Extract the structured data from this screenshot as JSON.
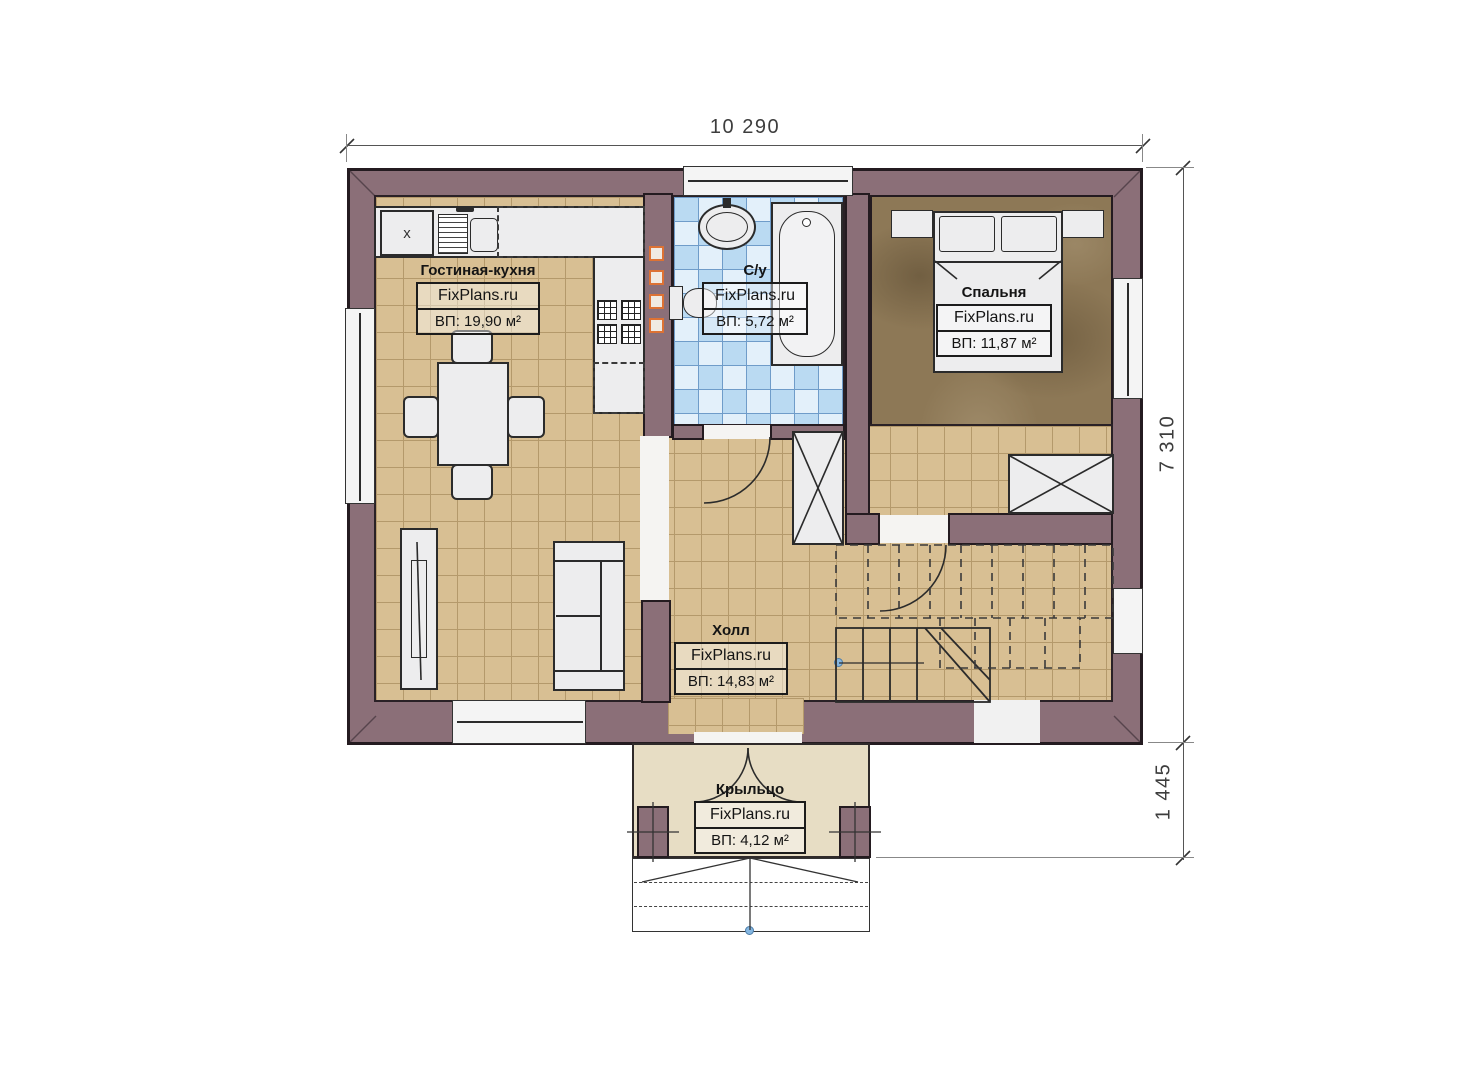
{
  "brand": "FixPlans.ru",
  "dimensions": {
    "top": "10 290",
    "right_main": "7 310",
    "right_porch": "1 445"
  },
  "rooms": [
    {
      "id": "living",
      "name": "Гостиная-кухня",
      "brand": "FixPlans.ru",
      "area": "ВП: 19,90 м²"
    },
    {
      "id": "bath",
      "name": "С/у",
      "brand": "FixPlans.ru",
      "area": "ВП: 5,72 м²"
    },
    {
      "id": "bedroom",
      "name": "Спальня",
      "brand": "FixPlans.ru",
      "area": "ВП: 11,87 м²"
    },
    {
      "id": "hall",
      "name": "Холл",
      "brand": "FixPlans.ru",
      "area": "ВП: 14,83 м²"
    },
    {
      "id": "porch",
      "name": "Крыльцо",
      "brand": "FixPlans.ru",
      "area": "ВП: 4,12 м²"
    }
  ],
  "markers": {
    "kitchen_cabinet": "x"
  },
  "colors": {
    "wall": "#8b6f78",
    "floor_tile": "#d8bf93",
    "floor_bath": "#badaf2",
    "floor_bedroom": "#8d7856",
    "floor_porch": "#e7ddc4",
    "accent_orange": "#dd7234",
    "marker_blue": "#85b7e2"
  }
}
